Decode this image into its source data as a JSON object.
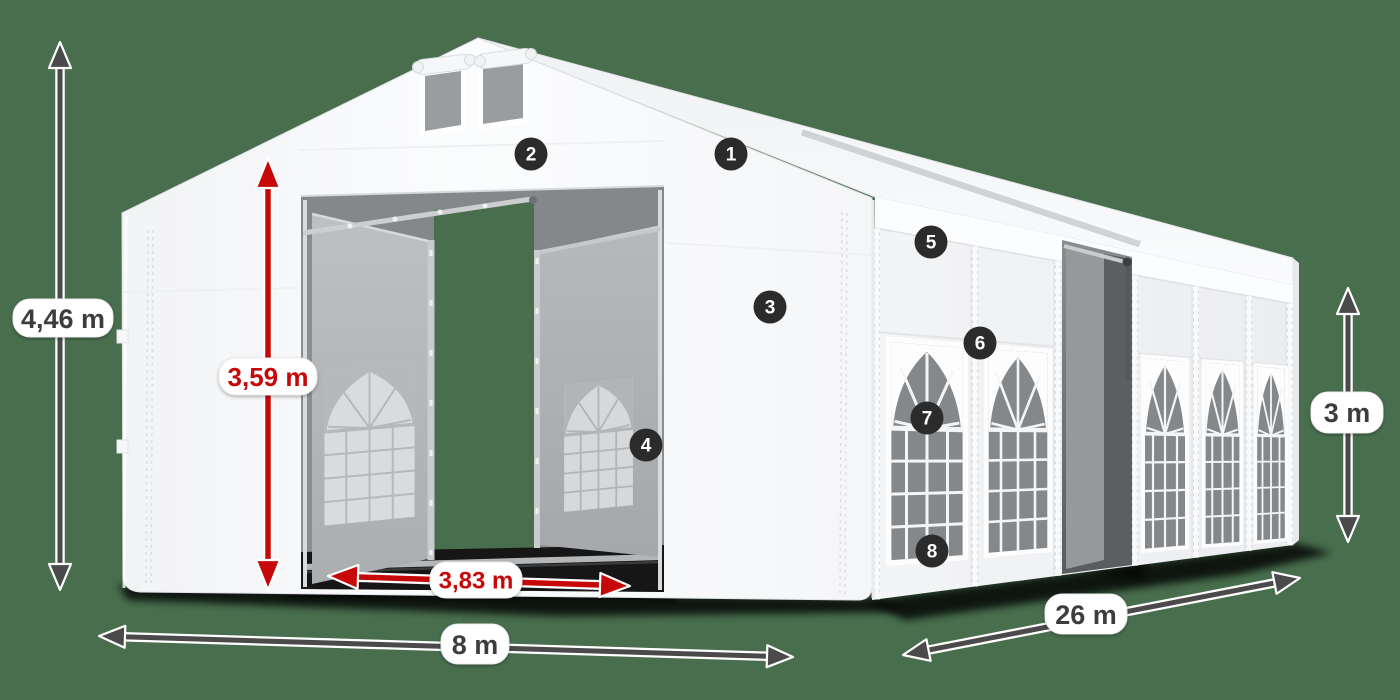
{
  "scene": {
    "background_color": "#486e4e",
    "arrow_color": "#4a4a4a",
    "red_accent_color": "#c70808",
    "badge_color": "#2b2b2b",
    "label_text_color": "#3d3d3d",
    "tent_color": "#f9fafb"
  },
  "dimension_labels": {
    "total_height": "4,46 m",
    "entrance_height": "3,59 m",
    "entrance_width": "3,83 m",
    "front_width": "8 m",
    "side_length": "26 m",
    "wall_height": "3 m"
  },
  "callout_badges": [
    {
      "number": "1"
    },
    {
      "number": "2"
    },
    {
      "number": "3"
    },
    {
      "number": "4"
    },
    {
      "number": "5"
    },
    {
      "number": "6"
    },
    {
      "number": "7"
    },
    {
      "number": "8"
    }
  ]
}
